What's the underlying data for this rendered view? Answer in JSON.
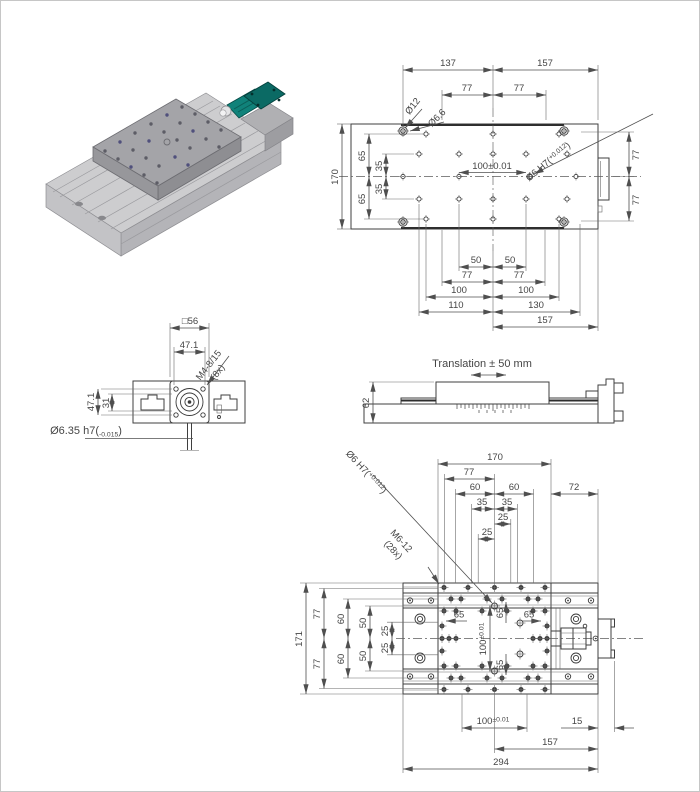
{
  "colors": {
    "line": "#3f3f3f",
    "dim_text": "#454545",
    "teal": "#0f7f78",
    "teal_dark": "#0a645e",
    "gray_light": "#cdcdcf",
    "gray_mid": "#a4a4a8",
    "gray_dark": "#8e8e92"
  },
  "top_view": {
    "dim_137": "137",
    "dim_157": "157",
    "dim_77a": "77",
    "dim_77b": "77",
    "label_d12": "Ø12",
    "label_d66": "Ø6.6",
    "fit_main": "Ø6 H7(",
    "fit_tol": "+0.012",
    "fit_close": ")",
    "dim_170": "170",
    "dim_65_u": "65",
    "dim_65_l": "65",
    "dim_35_u": "35",
    "dim_35_l": "35",
    "dim_100": "100±0.01",
    "dim_77_r1": "77",
    "dim_77_r2": "77",
    "dim_50_l": "50",
    "dim_50_r": "50",
    "dim_77_bl": "77",
    "dim_77_br": "77",
    "dim_100_l": "100",
    "dim_100_r": "100",
    "dim_110": "110",
    "dim_130": "130",
    "dim_157_b": "157"
  },
  "front_view": {
    "dim_sq56": "□56",
    "dim_471_top": "47.1",
    "thread_label": "M4-8/15",
    "thread_count": "(8x)",
    "dim_471_left": "47.1",
    "dim_31": "31",
    "shaft_main": "Ø6.35 h7(",
    "shaft_tol": "-0.015",
    "shaft_close": ")"
  },
  "side_view": {
    "title": "Translation ± 50 mm",
    "dim_62": "62"
  },
  "bottom_view": {
    "dim_170": "170",
    "dim_77": "77",
    "dim_60_l": "60",
    "dim_60_r": "60",
    "dim_35_l": "35",
    "dim_35_r": "35",
    "dim_25_u": "25",
    "dim_25_lo": "25",
    "dim_72": "72",
    "fit_main": "Ø6 H7(",
    "fit_tol": "+0.012",
    "fit_close": ")",
    "thread_label": "M6-12",
    "thread_count": "(28x)",
    "dim_171": "171",
    "dim_77_t": "77",
    "dim_77_b": "77",
    "dim_60_t": "60",
    "dim_60_b": "60",
    "dim_50_t": "50",
    "dim_50_b": "50",
    "dim_25_t": "25",
    "dim_25_b": "25",
    "dim_65_w": "65",
    "dim_65_n": "65",
    "dim_65_e": "65",
    "dim_65_s": "65",
    "dim_100v_main": "100",
    "dim_100v_tol": "±0.01",
    "dim_100b_main": "100",
    "dim_100b_tol": "±0.01",
    "dim_15": "15",
    "dim_157": "157",
    "dim_294": "294"
  }
}
